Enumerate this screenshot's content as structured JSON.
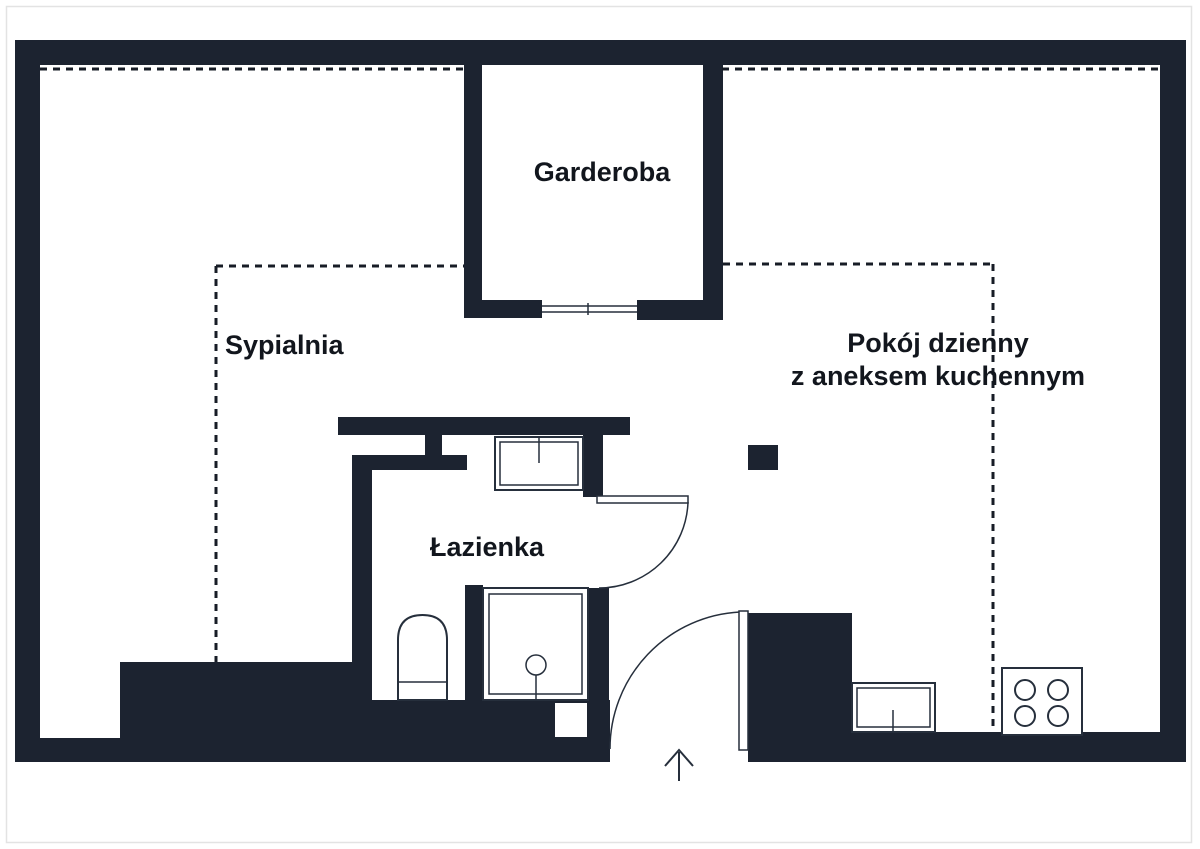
{
  "plan": {
    "type": "apartment-floor-plan",
    "palette": {
      "wall": "#1c2330",
      "floor": "#ffffff",
      "dotted_line": "#171c26",
      "fixture_line": "#262f3c",
      "text": "#12161d",
      "page_border": "#e3e3e3"
    },
    "rooms": {
      "garderoba": {
        "label": "Garderoba"
      },
      "sypialnia": {
        "label": "Sypialnia"
      },
      "living_room": {
        "label_line1": "Pokój dzienny",
        "label_line2": "z aneksem kuchennym"
      },
      "lazienka": {
        "label": "Łazienka"
      }
    },
    "symbols": [
      "toilet-symbol",
      "shower-symbol",
      "bathroom-sink-symbol",
      "kitchen-sink-symbol",
      "stove-symbol",
      "column-symbol",
      "bathroom-door-arc",
      "entrance-door-arc",
      "wardrobe-sliding-door",
      "entrance-arrow-icon"
    ]
  }
}
